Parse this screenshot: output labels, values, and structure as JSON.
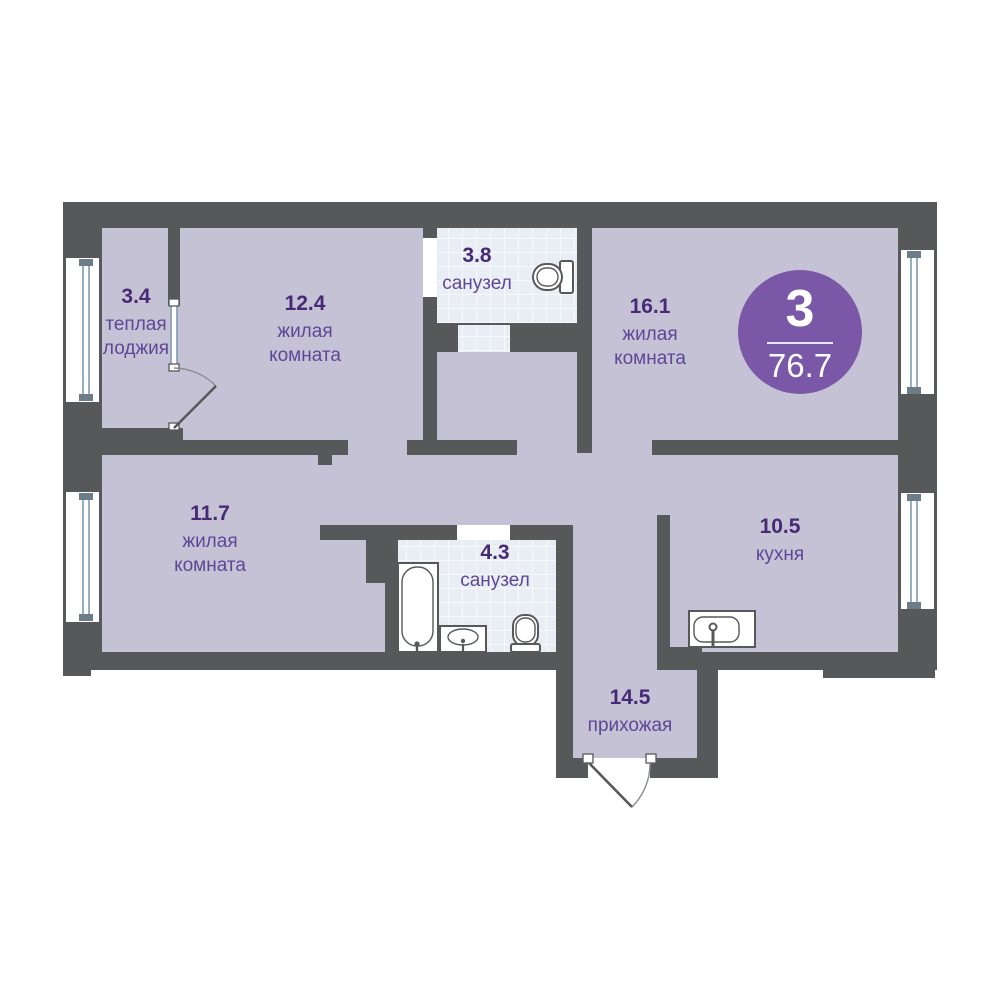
{
  "colors": {
    "wall": "#57585a",
    "floor": "#c6c2d5",
    "tile": "#e9edf4",
    "accent": "#7b57a7",
    "textDark": "#462a75",
    "textMid": "#5e4796",
    "windowBlue": "#7f9dae",
    "capGray": "#6d7d87"
  },
  "badge": {
    "rooms": "3",
    "area": "76.7"
  },
  "rooms": [
    {
      "area": "3.4",
      "lines": [
        "теплая",
        "лоджия"
      ]
    },
    {
      "area": "12.4",
      "lines": [
        "жилая",
        "комната"
      ]
    },
    {
      "area": "3.8",
      "lines": [
        "санузел"
      ]
    },
    {
      "area": "16.1",
      "lines": [
        "жилая",
        "комната"
      ]
    },
    {
      "area": "11.7",
      "lines": [
        "жилая",
        "комната"
      ]
    },
    {
      "area": "4.3",
      "lines": [
        "санузел"
      ]
    },
    {
      "area": "10.5",
      "lines": [
        "кухня"
      ]
    },
    {
      "area": "14.5",
      "lines": [
        "прихожая"
      ]
    }
  ]
}
